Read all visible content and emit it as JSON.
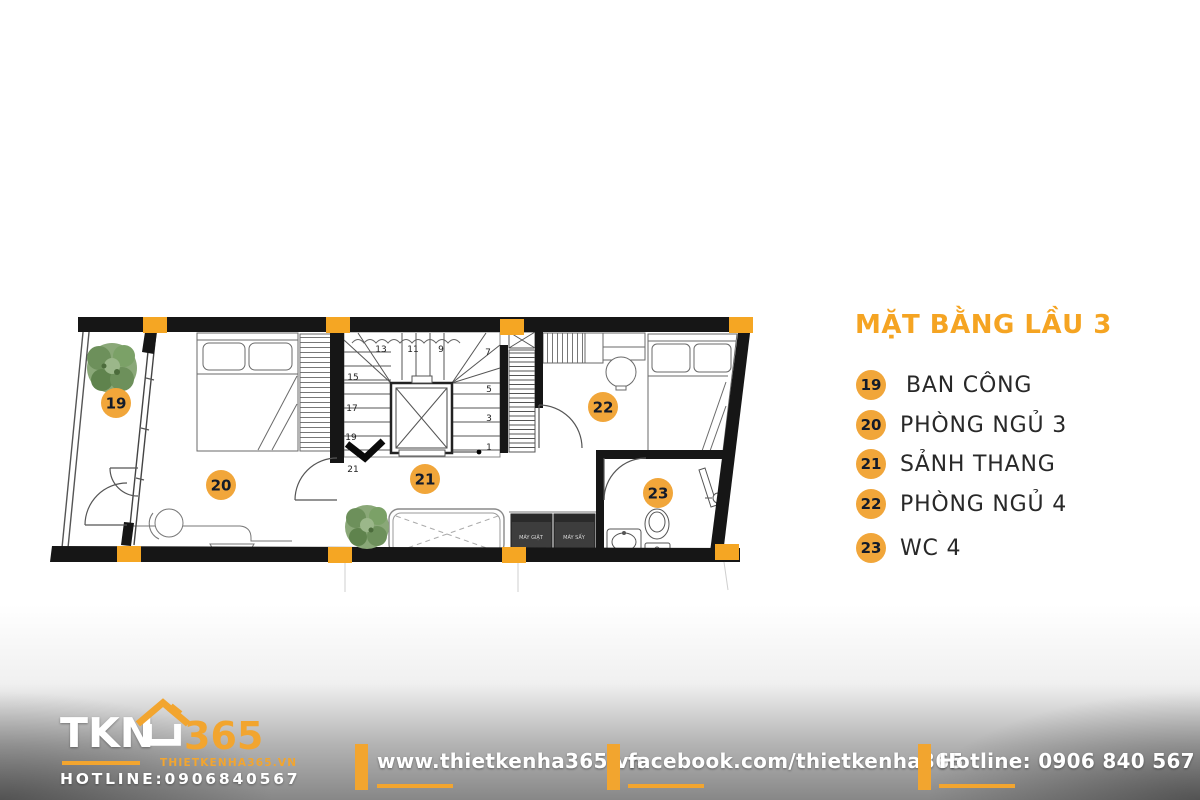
{
  "title": "MẶT BẰNG LẦU 3",
  "colors": {
    "accent_orange": "#F2A632",
    "wall_black": "#161616",
    "badge_text": "#131B2A",
    "tree_green": "#7BA167",
    "appliance_dark": "#3D3D3D",
    "footer_gray": "#878787"
  },
  "legend": {
    "items": [
      {
        "number": "19",
        "label": "BAN CÔNG"
      },
      {
        "number": "20",
        "label": "PHÒNG NGỦ 3"
      },
      {
        "number": "21",
        "label": "SẢNH THANG"
      },
      {
        "number": "22",
        "label": "PHÒNG NGỦ 4"
      },
      {
        "number": "23",
        "label": "WC 4"
      }
    ]
  },
  "plan": {
    "badges": [
      {
        "number": "19"
      },
      {
        "number": "20"
      },
      {
        "number": "21"
      },
      {
        "number": "22"
      },
      {
        "number": "23"
      }
    ],
    "stair_numbers": [
      "1",
      "3",
      "5",
      "7",
      "9",
      "11",
      "13",
      "15",
      "17",
      "19",
      "21"
    ],
    "appliances": {
      "washer": "MÁY GIẶT",
      "dryer": "MÁY SẤY"
    }
  },
  "footer": {
    "logo": {
      "tkn": "TKN",
      "n365": "365",
      "site": "THIETKENHA365.VN",
      "hotline": "HOTLINE:0906840567"
    },
    "website": "www.thietkenha365.vn",
    "facebook": "facebook.com/thietkenha365",
    "hotline": "Hotline: 0906 840 567"
  }
}
